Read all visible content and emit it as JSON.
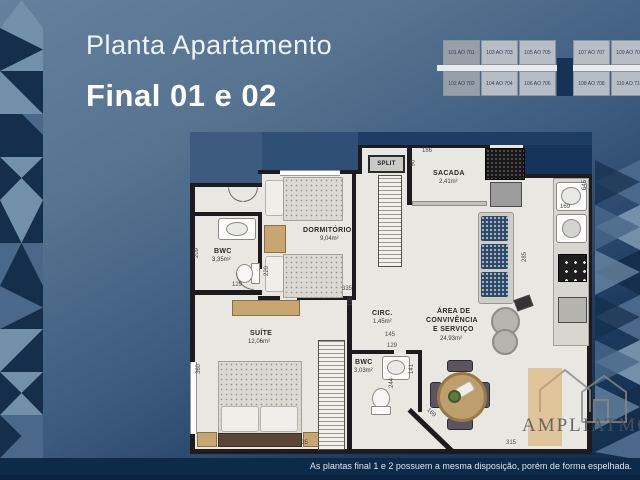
{
  "page": {
    "title_line1": "Planta Apartamento",
    "title_line2": "Final 01 e 02",
    "disclaimer": "As plantas final 1 e 2 possuem a mesma disposição, porém de forma espelhada.",
    "watermark": "AMPLIATMO"
  },
  "colors": {
    "background_top": "#63809d",
    "background_bottom": "#102c4a",
    "plan_floor": "#e9e7e2",
    "wall": "#1c1c1e",
    "pattern_light": "#7390ab",
    "pattern_mid": "#49688a",
    "pattern_dark": "#152e4c"
  },
  "keyplan": {
    "rows": [
      {
        "cells": [
          "101 AO 701",
          "103 AO 703",
          "105 AO 705",
          "107 AO 707",
          "109 AO 709"
        ]
      },
      {
        "cells": [
          "102 AO 702",
          "104 AO 704",
          "106 AO 706",
          "108 AO 708",
          "110 AO 710"
        ]
      }
    ]
  },
  "rooms": {
    "bwc1": {
      "name": "BWC",
      "area": "3,35m²"
    },
    "dormitorio": {
      "name": "DORMITÓRIO",
      "area": "9,04m²"
    },
    "suite": {
      "name": "SUÍTE",
      "area": "12,06m²"
    },
    "circ": {
      "name": "CIRC.",
      "area": "1,45m²"
    },
    "bwc2": {
      "name": "BWC",
      "area": "3,03m²"
    },
    "convivencia": {
      "name_l1": "ÁREA DE",
      "name_l2": "CONVIVÊNCIA",
      "name_l3": "E SERVIÇO",
      "area": "24,93m²"
    },
    "sacada": {
      "name": "SACADA",
      "area": "2,41m²"
    },
    "split": "SPLIT"
  },
  "dims": {
    "d209": "209",
    "d129a": "129",
    "d220": "220",
    "d335a": "335",
    "d186": "186",
    "d90": "90",
    "d645": "645",
    "d169a": "169",
    "d285": "285",
    "d100": "100",
    "d145": "145",
    "d129b": "129",
    "d141": "141",
    "d244": "244",
    "d169b": "169",
    "d360": "360",
    "d335b": "335",
    "d315": "315"
  }
}
